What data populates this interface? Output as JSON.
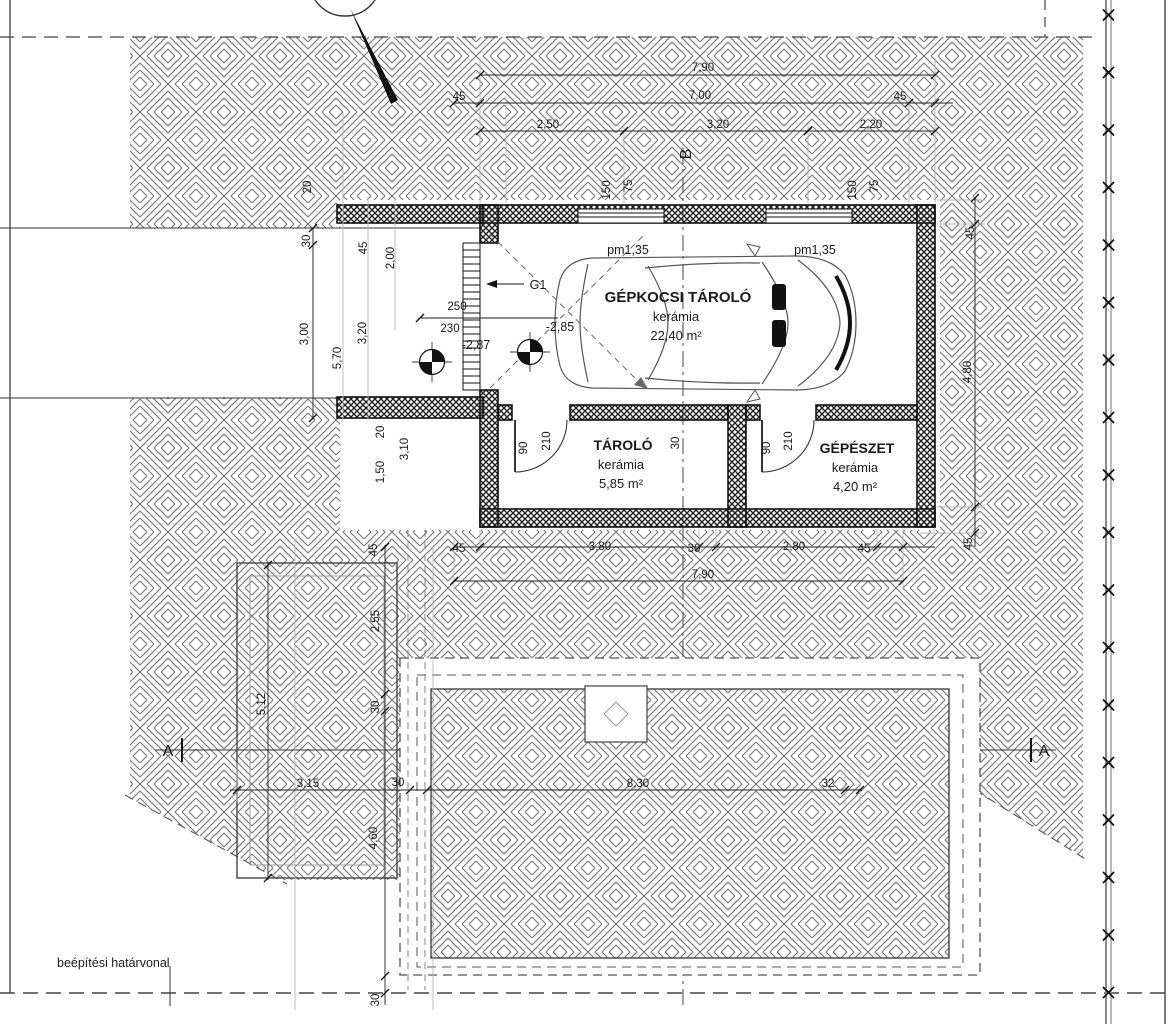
{
  "colors": {
    "line": "#1a1a1a",
    "hatch": "#7a7a7a",
    "wall_fill": "#2e2e2e",
    "construction_line": "#b5b5b5",
    "dash_line": "#555555"
  },
  "rooms": [
    {
      "id": "room-garage",
      "name": "GÉPKOCSI TÁROLÓ",
      "finish": "kerámia",
      "area": "22,40 m²",
      "x": 678,
      "y": 302,
      "name_size": 15
    },
    {
      "id": "room-storage",
      "name": "TÁROLÓ",
      "finish": "kerámia",
      "area": "5,85 m²",
      "x": 623,
      "y": 450,
      "name_size": 14
    },
    {
      "id": "room-mechanical",
      "name": "GÉPÉSZET",
      "finish": "kerámia",
      "area": "4,20 m²",
      "x": 857,
      "y": 453,
      "name_size": 14
    }
  ],
  "dimensions": [
    {
      "id": "dim-top-total",
      "text": "7,90",
      "x": 703,
      "y": 71
    },
    {
      "id": "dim-top-wall-left",
      "text": "45",
      "x": 459,
      "y": 100
    },
    {
      "id": "dim-top-inner",
      "text": "7,00",
      "x": 700,
      "y": 99
    },
    {
      "id": "dim-top-wall-right",
      "text": "45",
      "x": 900,
      "y": 100
    },
    {
      "id": "dim-top-seg1",
      "text": "2,50",
      "x": 548,
      "y": 128
    },
    {
      "id": "dim-top-seg2",
      "text": "3,20",
      "x": 718,
      "y": 128
    },
    {
      "id": "dim-top-seg3",
      "text": "2,20",
      "x": 871,
      "y": 128
    },
    {
      "id": "dim-win1-h",
      "text": "150",
      "x": 610,
      "y": 190,
      "rot": -90
    },
    {
      "id": "dim-win1-sill",
      "text": "75",
      "x": 632,
      "y": 186,
      "rot": -90
    },
    {
      "id": "dim-win2-h",
      "text": "150",
      "x": 856,
      "y": 190,
      "rot": -90
    },
    {
      "id": "dim-win2-sill",
      "text": "75",
      "x": 878,
      "y": 186,
      "rot": -90
    },
    {
      "id": "dim-left-20",
      "text": "20",
      "x": 311,
      "y": 187,
      "rot": -90
    },
    {
      "id": "dim-left-30",
      "text": "30",
      "x": 310,
      "y": 241,
      "rot": -90
    },
    {
      "id": "dim-left-300",
      "text": "3,00",
      "x": 308,
      "y": 334,
      "rot": -90
    },
    {
      "id": "dim-left-570",
      "text": "5,70",
      "x": 341,
      "y": 358,
      "rot": -90
    },
    {
      "id": "dim-left-45",
      "text": "45",
      "x": 367,
      "y": 248,
      "rot": -90
    },
    {
      "id": "dim-left-320",
      "text": "3,20",
      "x": 366,
      "y": 333,
      "rot": -90
    },
    {
      "id": "dim-left-200",
      "text": "2,00",
      "x": 394,
      "y": 258,
      "rot": -90
    },
    {
      "id": "dim-door-250",
      "text": "250",
      "x": 457,
      "y": 310
    },
    {
      "id": "dim-door-230",
      "text": "230",
      "x": 450,
      "y": 332
    },
    {
      "id": "dim-door1-w",
      "text": "90",
      "x": 527,
      "y": 448,
      "rot": -90
    },
    {
      "id": "dim-door1-h",
      "text": "210",
      "x": 550,
      "y": 441,
      "rot": -90
    },
    {
      "id": "dim-door2-w",
      "text": "90",
      "x": 770,
      "y": 448,
      "rot": -90
    },
    {
      "id": "dim-door2-h",
      "text": "210",
      "x": 792,
      "y": 441,
      "rot": -90
    },
    {
      "id": "dim-midwall-30",
      "text": "30",
      "x": 679,
      "y": 443,
      "rot": -90
    },
    {
      "id": "dim-bot-45l",
      "text": "45",
      "x": 459,
      "y": 552
    },
    {
      "id": "dim-bot-380",
      "text": "3,80",
      "x": 600,
      "y": 550
    },
    {
      "id": "dim-bot-30",
      "text": "30",
      "x": 694,
      "y": 552
    },
    {
      "id": "dim-bot-280",
      "text": "2,80",
      "x": 794,
      "y": 550
    },
    {
      "id": "dim-bot-45r",
      "text": "45",
      "x": 864,
      "y": 552
    },
    {
      "id": "dim-bot-total",
      "text": "7,90",
      "x": 703,
      "y": 578
    },
    {
      "id": "dim-right-45t",
      "text": "45",
      "x": 974,
      "y": 233,
      "rot": -90
    },
    {
      "id": "dim-right-480",
      "text": "4,80",
      "x": 971,
      "y": 372,
      "rot": -90
    },
    {
      "id": "dim-right-45b",
      "text": "45",
      "x": 972,
      "y": 544,
      "rot": -90
    },
    {
      "id": "dim-ll-45",
      "text": "45",
      "x": 377,
      "y": 550,
      "rot": -90
    },
    {
      "id": "dim-ll-255",
      "text": "2,55",
      "x": 379,
      "y": 621,
      "rot": -90
    },
    {
      "id": "dim-ll-512",
      "text": "5,12",
      "x": 265,
      "y": 704,
      "rot": -90
    },
    {
      "id": "dim-ll-30",
      "text": "30",
      "x": 379,
      "y": 707,
      "rot": -90
    },
    {
      "id": "dim-ll-20",
      "text": "20",
      "x": 384,
      "y": 432,
      "rot": -90
    },
    {
      "id": "dim-ll-150",
      "text": "1,50",
      "x": 384,
      "y": 472,
      "rot": -90
    },
    {
      "id": "dim-ll-310",
      "text": "3,10",
      "x": 408,
      "y": 449,
      "rot": -90
    },
    {
      "id": "dim-row-315",
      "text": "3,15",
      "x": 308,
      "y": 787
    },
    {
      "id": "dim-row-30",
      "text": "30",
      "x": 398,
      "y": 786
    },
    {
      "id": "dim-row-830",
      "text": "8,30",
      "x": 638,
      "y": 787
    },
    {
      "id": "dim-row-32",
      "text": "32",
      "x": 828,
      "y": 787
    },
    {
      "id": "dim-460",
      "text": "4,60",
      "x": 377,
      "y": 838,
      "rot": -90
    },
    {
      "id": "dim-bottom-30",
      "text": "30",
      "x": 379,
      "y": 1000,
      "rot": -90
    }
  ],
  "markers": [
    {
      "id": "section-marker-a-left",
      "text": "A",
      "x": 168,
      "y": 756
    },
    {
      "id": "section-marker-a-right",
      "text": "A",
      "x": 1044,
      "y": 756
    },
    {
      "id": "section-marker-b",
      "text": "B",
      "x": 691,
      "y": 154,
      "rot": -90
    }
  ],
  "annotations": [
    {
      "id": "level-mark-garage",
      "text": "-2,85",
      "x": 560,
      "y": 331,
      "size": 12.5
    },
    {
      "id": "level-mark-entry",
      "text": "-2,87",
      "x": 476,
      "y": 349,
      "size": 12.5
    },
    {
      "id": "parapet-mark-1",
      "text": "pm1,35",
      "x": 628,
      "y": 254,
      "size": 12.5
    },
    {
      "id": "parapet-mark-2",
      "text": "pm1,35",
      "x": 815,
      "y": 254,
      "size": 12.5
    },
    {
      "id": "garage-door-label",
      "text": "G1",
      "x": 538,
      "y": 289,
      "size": 12.5
    },
    {
      "id": "boundary-note",
      "text": "beépítési határvonal",
      "x": 57,
      "y": 967,
      "size": 12.5,
      "anchor": "start"
    }
  ]
}
